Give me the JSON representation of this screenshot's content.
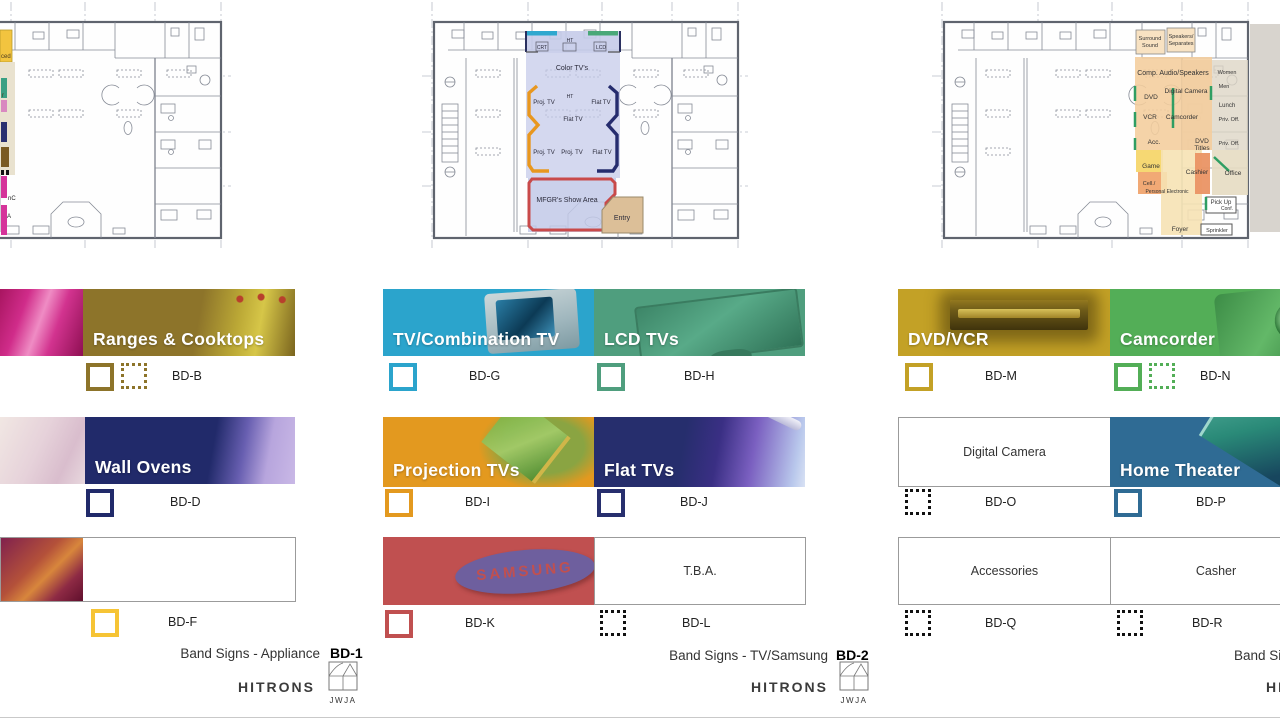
{
  "plans": [
    {
      "name": "floor-plan-appliance",
      "edge_labels": {
        "a": "ced",
        "b": "r",
        "c": "nC",
        "d": "A"
      }
    },
    {
      "name": "floor-plan-tv",
      "labels": {
        "color_tvs": "Color TV's",
        "crt": "CRT",
        "ht_top": "HT",
        "lcd": "LCD",
        "proj_tv_1": "Proj. TV",
        "ht_mid": "HT",
        "flat_tv_1": "Flat TV",
        "flat_tv_2": "Flat TV",
        "proj_tv_2": "Proj. TV",
        "proj_tv_3": "Proj. TV",
        "flat_tv_3": "Flat TV",
        "mfgr": "MFGR's Show Area",
        "entry": "Entry"
      }
    },
    {
      "name": "floor-plan-av",
      "labels": {
        "surround_1": "Surround",
        "surround_2": "Sound",
        "speakers_1": "Speakers/",
        "speakers_2": "Separates",
        "comp_audio": "Comp. Audio/Speakers",
        "women": "Women",
        "men": "Men",
        "dvd": "DVD",
        "digital_camera": "Digital Camera",
        "lunch": "Lunch",
        "vcr": "VCR",
        "camcorder": "Camcorder",
        "priv_off_1": "Priv. Off.",
        "priv_off_2": "Priv. Off.",
        "acc": "Acc.",
        "dvd_titles_1": "DVD",
        "dvd_titles_2": "Titles",
        "game": "Game",
        "cashier": "Cashier",
        "office": "Office",
        "cell_1": "Cell./",
        "cell_2": "Personal Electronic",
        "pick_up_1": "Pick Up",
        "pick_up_2": "Conf.",
        "foyer": "Foyer",
        "sprinkler": "Sprinkler"
      }
    }
  ],
  "bands": {
    "bd_b": {
      "title": "Ranges & Cooktops",
      "code": "BD-B"
    },
    "bd_d": {
      "title": "Wall Ovens",
      "code": "BD-D"
    },
    "bd_f": {
      "title": "",
      "code": "BD-F"
    },
    "bd_g": {
      "title": "TV/Combination TV",
      "code": "BD-G"
    },
    "bd_h": {
      "title": "LCD TVs",
      "code": "BD-H"
    },
    "bd_i": {
      "title": "Projection TVs",
      "code": "BD-I"
    },
    "bd_j": {
      "title": "Flat TVs",
      "code": "BD-J"
    },
    "bd_k": {
      "title": "SAMSUNG",
      "code": "BD-K"
    },
    "bd_l": {
      "title": "T.B.A.",
      "code": "BD-L"
    },
    "bd_m": {
      "title": "DVD/VCR",
      "code": "BD-M"
    },
    "bd_n": {
      "title": "Camcorder",
      "code": "BD-N"
    },
    "bd_o": {
      "title": "Digital Camera",
      "code": "BD-O"
    },
    "bd_p": {
      "title": "Home Theater",
      "code": "BD-P"
    },
    "bd_q": {
      "title": "Accessories",
      "code": "BD-Q"
    },
    "bd_r": {
      "title": "Casher",
      "code": "BD-R"
    }
  },
  "footers": [
    {
      "title": "Band Signs - Appliance",
      "code": "BD-1",
      "brand": "HITRONS",
      "logo": "JWJA"
    },
    {
      "title": "Band Signs - TV/Samsung",
      "code": "BD-2",
      "brand": "HITRONS",
      "logo": "JWJA"
    },
    {
      "title": "Band Sig",
      "code": "",
      "brand": "HI",
      "logo": ""
    }
  ],
  "colors": {
    "ranges_olive": "#8d742a",
    "wall_ovens_navy": "#212a6a",
    "bd_f_yellow": "#f6c435",
    "tv_comb_cyan": "#2ba4cc",
    "lcd_green": "#4f9e7e",
    "projection_orange": "#e3991f",
    "flat_navy": "#272f6e",
    "samsung_red": "#c05050",
    "samsung_logo_purple": "#6e5f9e",
    "dvd_vcr_gold": "#c3a126",
    "camcorder_green": "#53ae57",
    "home_theater_blue": "#2f6b94",
    "dotted_black": "#111111",
    "plan_lavender": "#c5cbe9",
    "plan_peach": "#f4cd9c",
    "plan_red_border": "#c94a4a",
    "plan_entry_tan": "#dcbf98",
    "plan_green_mark": "#2f9e63"
  }
}
